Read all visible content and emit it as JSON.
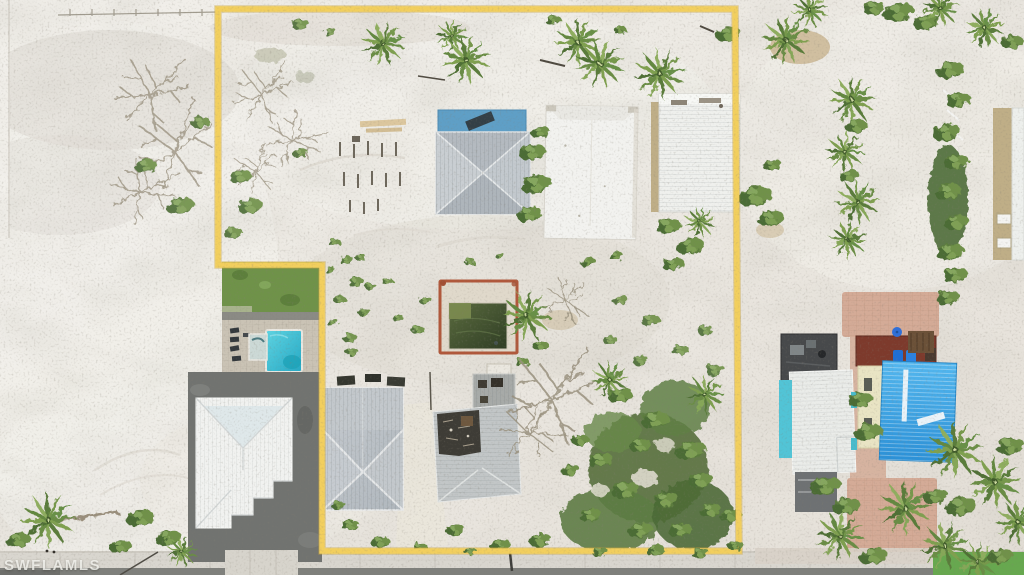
{
  "meta": {
    "description": "Aerial drone photo of a vacant coastal lot outlined in yellow: white sand, storm debris, an abandoned green pool with a red frame, damaged metal-roof houses, palm trees, neighboring homes with white, gray and blue metal roofs, a turquoise pool at left, and a street along the bottom.",
    "width": 1024,
    "height": 575
  },
  "watermark": {
    "text": "SWFLAMLS",
    "color": "rgba(247,246,242,0.82)"
  },
  "boundary": {
    "color": "#f2cf5e",
    "halo": "#c9a33f",
    "width": 5.5
  },
  "palette": {
    "sand": "#e9e5de",
    "sand_bright": "#f2f0eb",
    "sand_shade": "#dbd6cd",
    "sidewalk": "#d9d6cf",
    "road": "#7f807c",
    "gravel": "#717370",
    "lawn": "#6f9249",
    "grass_bright": "#67a84f",
    "paver_pink": "#d4ab97",
    "concrete": "#d7d4cc",
    "pool_teal_1": "#5fd4e2",
    "pool_teal_2": "#25a8c4",
    "pool_green_1": "#5a6b3e",
    "pool_green_2": "#2f3d24",
    "pool_frame_red": "#b0583b",
    "pool_deck": "#e0d9cb",
    "roof_white": "#f1f2f0",
    "roof_gray_1": "#c6cbd0",
    "roof_gray_2": "#b0b7bd",
    "roof_blue_1": "#53b7ef",
    "roof_blue_2": "#2b91d8",
    "deck_blue": "#5f9fc6",
    "deck_red": "#7d3a2c",
    "roof_deck_dark": "#47494b",
    "wall_teal": "#52c4d6",
    "wall_cream": "#e9e4c4",
    "wall_tan": "#bfae87",
    "veg_dark": "#4c6c36",
    "veg_mid": "#5b7c3e",
    "veg_light": "#7fa055"
  }
}
